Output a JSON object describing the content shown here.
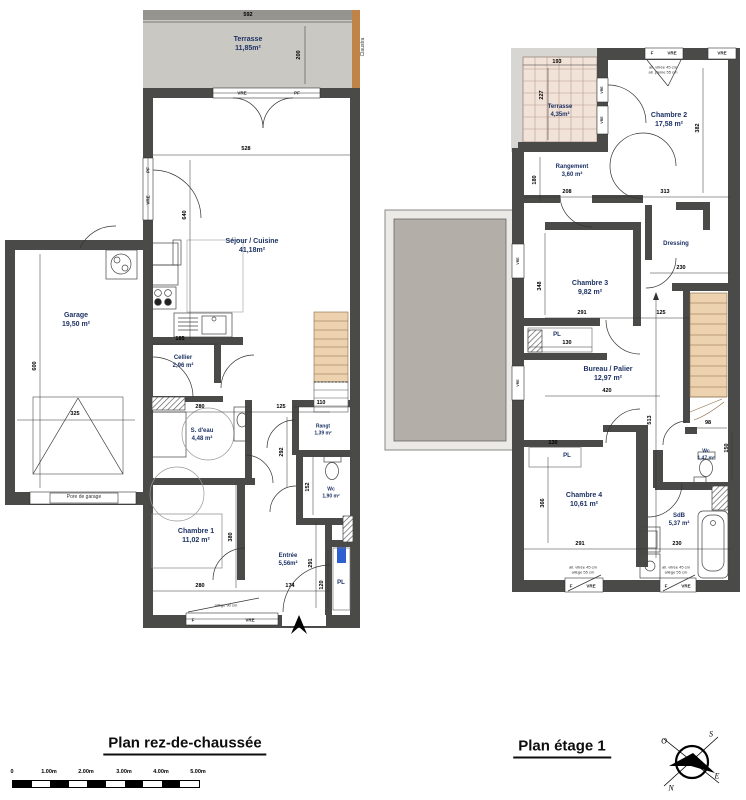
{
  "rdc": {
    "title": "Plan  rez-de-chaussée",
    "rooms": {
      "terrasse": {
        "name": "Terrasse",
        "area": "11,85m²"
      },
      "sejour": {
        "name": "Séjour  /  Cuisine",
        "area": "41,18m²"
      },
      "garage": {
        "name": "Garage",
        "area": "19,50  m²"
      },
      "cellier": {
        "name": "Cellier",
        "area": "2,96  m²"
      },
      "sdeau": {
        "name": "S. d'eau",
        "area": "4,48  m²"
      },
      "rangt": {
        "name": "Rangt",
        "area": "1,39 m²"
      },
      "wc": {
        "name": "Wc",
        "area": "1,90  m²"
      },
      "chambre1": {
        "name": "Chambre  1",
        "area": "11,02  m²"
      },
      "entree": {
        "name": "Entrée",
        "area": "5,56m²"
      },
      "pl": "PL"
    },
    "dims": {
      "terrasse_w": "592",
      "terrasse_h": "200",
      "sejour_w": "528",
      "sejour_h": "640",
      "garage_h": "600",
      "garage_door_w": "325",
      "cellier_w": "185",
      "sdeau_w": "280",
      "hall_w": "125",
      "sdeau_h": "292",
      "rangt_w": "110",
      "wc_h": "152",
      "chambre1_h": "380",
      "entree_h": "291",
      "chambre1_w": "280",
      "entree_w": "174",
      "pl_h": "120"
    },
    "annotations": {
      "claustra": "Claustra",
      "garage_door": "Pore de garage",
      "allege90": "allège 90 cm"
    }
  },
  "etage": {
    "title": "Plan  étage  1",
    "rooms": {
      "terrasse": {
        "name": "Terrasse",
        "area": "4,35m²"
      },
      "chambre2": {
        "name": "Chambre  2",
        "area": "17,58  m²"
      },
      "rangement": {
        "name": "Rangement",
        "area": "3,60  m²"
      },
      "dressing": {
        "name": "Dressing"
      },
      "chambre3": {
        "name": "Chambre  3",
        "area": "9,82  m²"
      },
      "bureau": {
        "name": "Bureau  /  Palier",
        "area": "12,97  m²"
      },
      "pl_a": "PL",
      "pl_b": "PL",
      "chambre4": {
        "name": "Chambre  4",
        "area": "10,61  m²"
      },
      "wc": {
        "name": "Wc",
        "area": "1,47 m²"
      },
      "sdb": {
        "name": "SdB",
        "area": "5,37  m²"
      }
    },
    "dims": {
      "terrasse_w": "193",
      "terrasse_h": "227",
      "chambre2_h": "382",
      "rangement_h": "180",
      "rangement_w": "208",
      "chambre2_w": "313",
      "dressing_w": "230",
      "chambre3_w": "291",
      "hall_w": "125",
      "chambre3_h": "348",
      "pl_a_w": "130",
      "bureau_w": "420",
      "mid_h": "513",
      "wc_w": "98",
      "wc_h": "150",
      "pl_b_w": "130",
      "chambre4_w": "291",
      "chambre4_h": "366",
      "sdb_w": "230"
    },
    "annotations": {
      "allege_v45": "all. vitrée 45 cm",
      "allege_p55": "all. pleine 55 cm",
      "allege55": "allège 55 cm"
    }
  },
  "windows": {
    "f": "F",
    "vre": "VRE",
    "pf": "PF"
  },
  "scalebar": {
    "labels": [
      "0",
      "1.00m",
      "2.00m",
      "3.00m",
      "4.00m",
      "5.00m"
    ]
  },
  "compass": {
    "o": "O",
    "s": "S",
    "n": "N",
    "e": "E"
  },
  "colors": {
    "wall": "#4a4a48",
    "terrasse_rdc": "#cac8c3",
    "terrasse_etage": "#f2e3d9",
    "wood": "#ecd2ae",
    "claustra": "#c08348",
    "roof": "#b3aea8",
    "label": "#1d3264"
  }
}
